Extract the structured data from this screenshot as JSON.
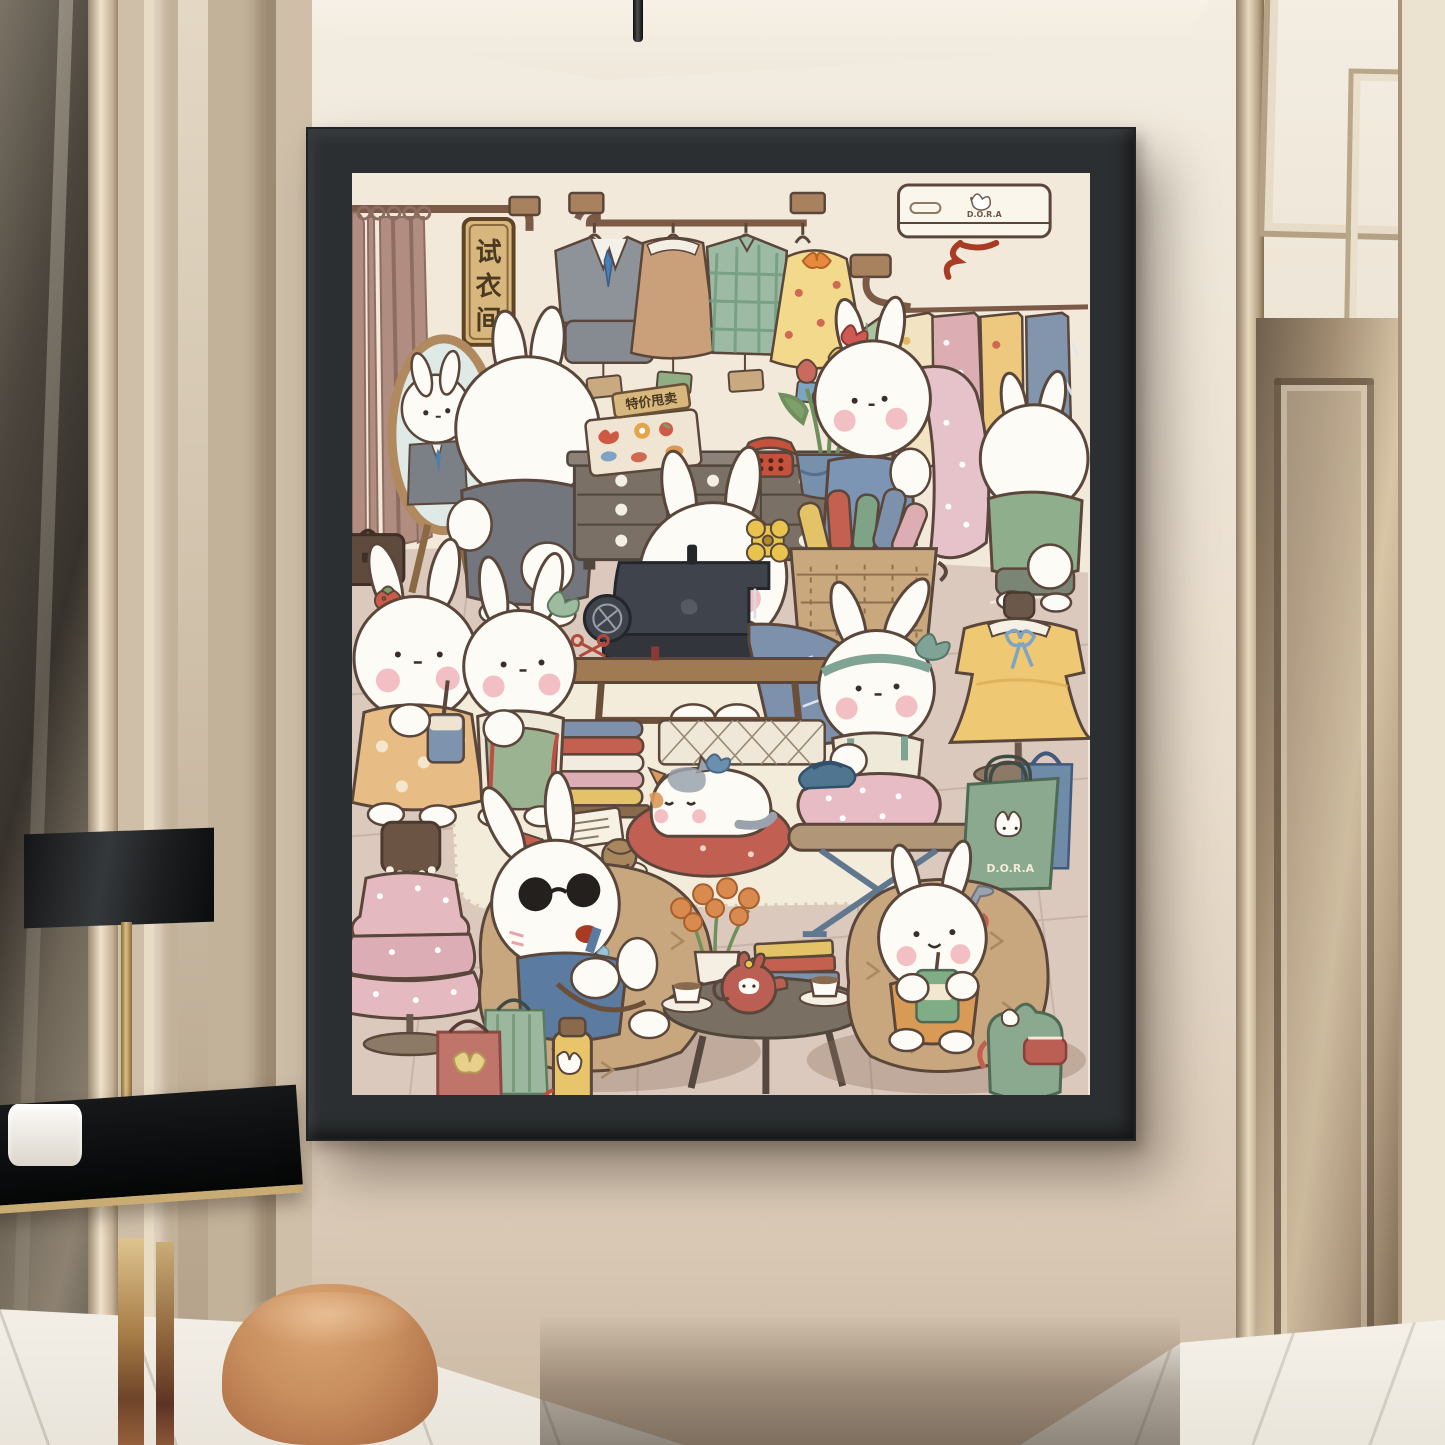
{
  "photo": {
    "type": "interior photo: black-framed kawaii art print hanging in a modern hallway",
    "frame": {
      "color": "#2c2f31",
      "style": "black box frame with bevel"
    },
    "environment": {
      "wall_color": "#e9ddcd",
      "left_side": "dark mirror strip and champagne-gold pillar panelling",
      "right_side": "champagne metallic panelled door and trim",
      "floor": "white marble with grey veining",
      "hanging_rod": "thin black rod from ceiling above frame",
      "furniture": [
        {
          "name": "console-table",
          "desc": "black glass top with gold edge and gold bar legs"
        },
        {
          "name": "table-lamp",
          "desc": "black rectangular shade on gold stem"
        },
        {
          "name": "white-vessel",
          "desc": "white cylindrical vase on tabletop"
        },
        {
          "name": "pouf",
          "desc": "round caramel suede stool"
        }
      ]
    }
  },
  "poster": {
    "style": "cute bunny tailor / fitting-room illustration",
    "background": "#f2e9db",
    "texts": {
      "fitting_room_sign": {
        "chars": [
          "试",
          "衣",
          "间"
        ]
      },
      "special_price_sign": {
        "text": "特价甩卖"
      },
      "ac_brand": "D.O.R.A",
      "bag_brand": "D.O.R.A"
    },
    "clothes_rack": {
      "items": [
        "grey suit with blue tie",
        "tan dress with white collar",
        "green plaid shirt",
        "yellow floral dress with orange bow"
      ],
      "price_tags": [
        "tan",
        "green",
        "tan",
        "blue"
      ]
    },
    "fabric_display": [
      "green plaid",
      "cream floral",
      "pink polka dot",
      "yellow floral",
      "blue leaf print"
    ],
    "objects": [
      "air conditioner with bunny logo and red ribbon",
      "mauve curtain on rod",
      "oval wooden mirror",
      "brown briefcase",
      "chest of drawers with bunny handles",
      "accessory tray",
      "red rotary telephone",
      "tulips in blue pot",
      "wicker basket with fabric rolls",
      "vintage sewing machine on wooden table",
      "stack of folded fabric",
      "white wool rug",
      "notepad",
      "red pencil",
      "yarn ball",
      "red floral cat cushion",
      "ironing board with blue iron",
      "dress form with yellow dress and blue ribbon",
      "dress form with pink polka dress and pearls",
      "green D.O.R.A shopping bag",
      "blue shopping bag",
      "red bow gift bag",
      "green striped bag",
      "yellow bunny thermos",
      "round coffee table",
      "red bunny teapot",
      "two teacups",
      "book stack",
      "orange flowers in vase",
      "green backpack with bunny"
    ],
    "characters": [
      "bunny trying on grey suit at mirror",
      "bunny with red bow draping pink polka fabric",
      "bunny in green tee browsing fabrics (back view)",
      "seamstress bunny with yellow flower at sewing machine",
      "bunny with strawberry ear drinking boba",
      "bunny with green bow, apron and measuring tape",
      "bunny with teal headband ironing pink fabric",
      "napping bunny with sunglasses on beanbag",
      "bunny with juice box on beanbag",
      "calico cat sleeping on cushion"
    ]
  },
  "palette": {
    "art_wall": "#f2e9db",
    "art_floor": "#dcc9be",
    "outline": "#5a463a",
    "bunny_white": "#fdfbf6",
    "blush": "#f2c0c4",
    "wood": "#a07a52",
    "grey_suit": "#8e9399",
    "denim_blue": "#7d95b5",
    "leaf_green": "#9cb391",
    "butter_yellow": "#eec873",
    "berry_red": "#bb5f55",
    "basket_tan": "#c9a87e"
  }
}
